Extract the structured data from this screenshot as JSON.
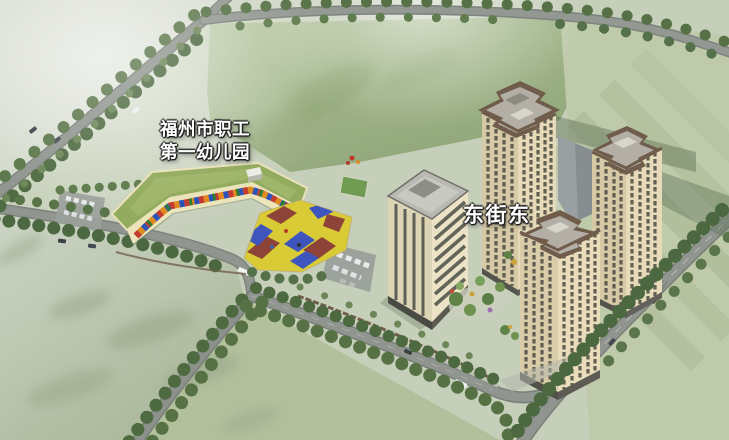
{
  "scene": {
    "type": "aerial-3d-architectural-rendering",
    "subject": "Kindergarten, office tower and residential towers among green fields and tree-lined roads"
  },
  "labels": {
    "kindergarten_line1": "福州市职工",
    "kindergarten_line2": "第一幼儿园",
    "street": "东街东"
  },
  "palette": {
    "field_light": "#ccd3c2",
    "field_mid": "#b7c5a4",
    "field_deep": "#8aa272",
    "road": "#90958f",
    "tree": "#4f6b42",
    "kindergarten_roof": "#93ab5e",
    "kindergarten_wall": "#ece4ba",
    "playground_yellow": "#d9cb36",
    "playground_blue": "#3d55bd",
    "playground_red": "#8e4338",
    "office_wall": "#e7dfc2",
    "tower_wall": "#e3d8b6",
    "tower_trim": "#6f5c4a",
    "shadow_green": "#5d7255",
    "label_text": "#ffffff"
  }
}
